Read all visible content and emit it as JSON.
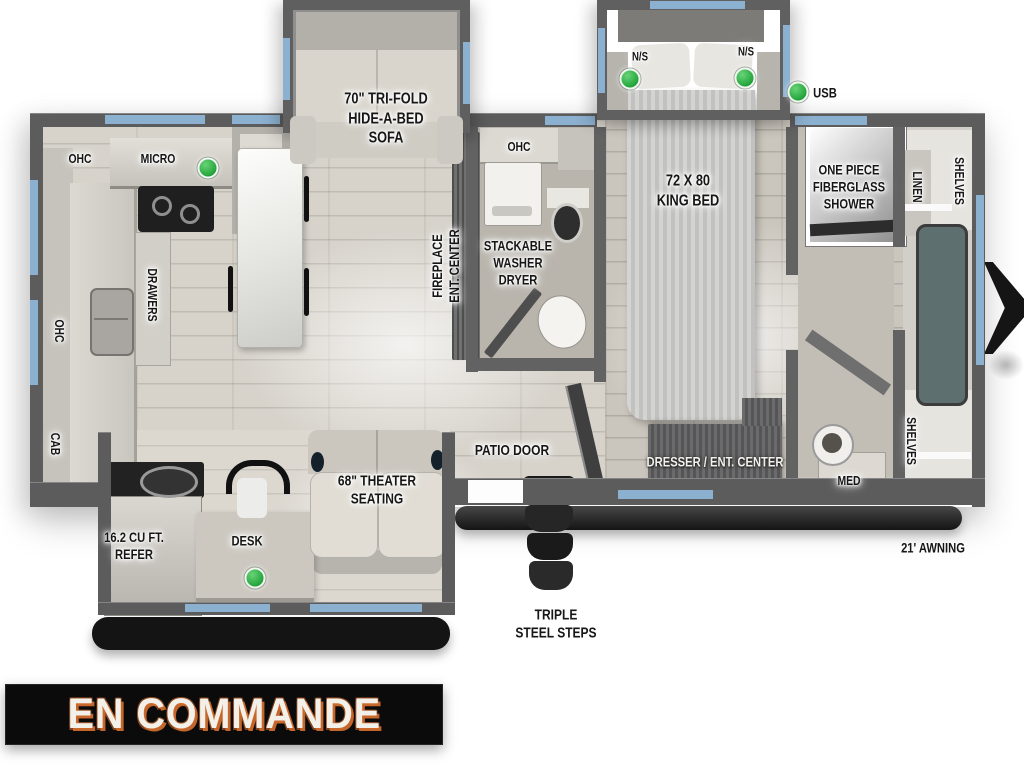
{
  "status_banner": {
    "text": "EN COMMANDE"
  },
  "colors": {
    "accent_window_blue": "#8cb0cf",
    "indicator_green": "#2fae4a",
    "banner_bg": "#0b0b0b",
    "banner_text": "#f3f0ea",
    "banner_outline": "#cf6b2d",
    "wall_gray": "#5c5c5c"
  },
  "labels": [
    {
      "id": "ohc-kitchen-top",
      "text": "OHC",
      "x": 80,
      "y": 159,
      "rot": 0,
      "fs": 13
    },
    {
      "id": "microwave",
      "text": "MICRO",
      "x": 158,
      "y": 159,
      "rot": 0,
      "fs": 13
    },
    {
      "id": "tri-fold-sofa",
      "text": "70\" TRI-FOLD\nHIDE-A-BED\nSOFA",
      "x": 386,
      "y": 119,
      "rot": 0,
      "fs": 16
    },
    {
      "id": "ohc-bathroom",
      "text": "OHC",
      "x": 519,
      "y": 147,
      "rot": 0,
      "fs": 13
    },
    {
      "id": "nightstand-left",
      "text": "N/S",
      "x": 640,
      "y": 57,
      "rot": 0,
      "fs": 12
    },
    {
      "id": "nightstand-right",
      "text": "N/S",
      "x": 746,
      "y": 52,
      "rot": 0,
      "fs": 12
    },
    {
      "id": "usb",
      "text": "USB",
      "x": 825,
      "y": 93,
      "rot": 0,
      "fs": 14
    },
    {
      "id": "king-bed",
      "text": "72 X 80\nKING BED",
      "x": 688,
      "y": 191,
      "rot": 0,
      "fs": 16
    },
    {
      "id": "fiberglass-shower",
      "text": "ONE PIECE\nFIBERGLASS\nSHOWER",
      "x": 849,
      "y": 187,
      "rot": 0,
      "fs": 14
    },
    {
      "id": "linen",
      "text": "LINEN",
      "x": 917,
      "y": 187,
      "rot": 90,
      "fs": 13
    },
    {
      "id": "shelves-top",
      "text": "SHELVES",
      "x": 959,
      "y": 181,
      "rot": 90,
      "fs": 13
    },
    {
      "id": "fireplace-ent-center",
      "text": "FIREPLACE\nENT. CENTER",
      "x": 446,
      "y": 266,
      "rot": -90,
      "fs": 14
    },
    {
      "id": "stackable-washer-dryer",
      "text": "STACKABLE\nWASHER\nDRYER",
      "x": 518,
      "y": 263,
      "rot": 0,
      "fs": 14
    },
    {
      "id": "ohc-left-wall",
      "text": "OHC",
      "x": 59,
      "y": 331,
      "rot": 90,
      "fs": 13
    },
    {
      "id": "cab-left-wall",
      "text": "CAB",
      "x": 55,
      "y": 444,
      "rot": 90,
      "fs": 13
    },
    {
      "id": "drawers",
      "text": "DRAWERS",
      "x": 152,
      "y": 295,
      "rot": 90,
      "fs": 13
    },
    {
      "id": "patio-door",
      "text": "PATIO DOOR",
      "x": 512,
      "y": 451,
      "rot": 0,
      "fs": 15
    },
    {
      "id": "dresser-ent-center",
      "text": "DRESSER / ENT. CENTER",
      "x": 715,
      "y": 462,
      "rot": 0,
      "fs": 14,
      "style": "light"
    },
    {
      "id": "med-cabinet",
      "text": "MED",
      "x": 849,
      "y": 481,
      "rot": 0,
      "fs": 13
    },
    {
      "id": "shelves-bottom",
      "text": "SHELVES",
      "x": 911,
      "y": 441,
      "rot": 90,
      "fs": 13
    },
    {
      "id": "refrigerator",
      "text": "16.2 CU FT.\nREFER",
      "x": 134,
      "y": 546,
      "rot": 0,
      "fs": 14
    },
    {
      "id": "desk",
      "text": "DESK",
      "x": 247,
      "y": 541,
      "rot": 0,
      "fs": 14
    },
    {
      "id": "theater-seating",
      "text": "68\" THEATER\nSEATING",
      "x": 377,
      "y": 491,
      "rot": 0,
      "fs": 15
    },
    {
      "id": "triple-steel-steps",
      "text": "TRIPLE\nSTEEL STEPS",
      "x": 556,
      "y": 625,
      "rot": 0,
      "fs": 15
    },
    {
      "id": "awning",
      "text": "21' AWNING",
      "x": 933,
      "y": 548,
      "rot": 0,
      "fs": 14
    }
  ],
  "indicators": [
    {
      "id": "microwave-light",
      "x": 208,
      "y": 168
    },
    {
      "id": "nightstand-left-light",
      "x": 630,
      "y": 79
    },
    {
      "id": "nightstand-right-light",
      "x": 745,
      "y": 78
    },
    {
      "id": "usb-port-light",
      "x": 798,
      "y": 92
    },
    {
      "id": "desk-light",
      "x": 255,
      "y": 578
    }
  ]
}
